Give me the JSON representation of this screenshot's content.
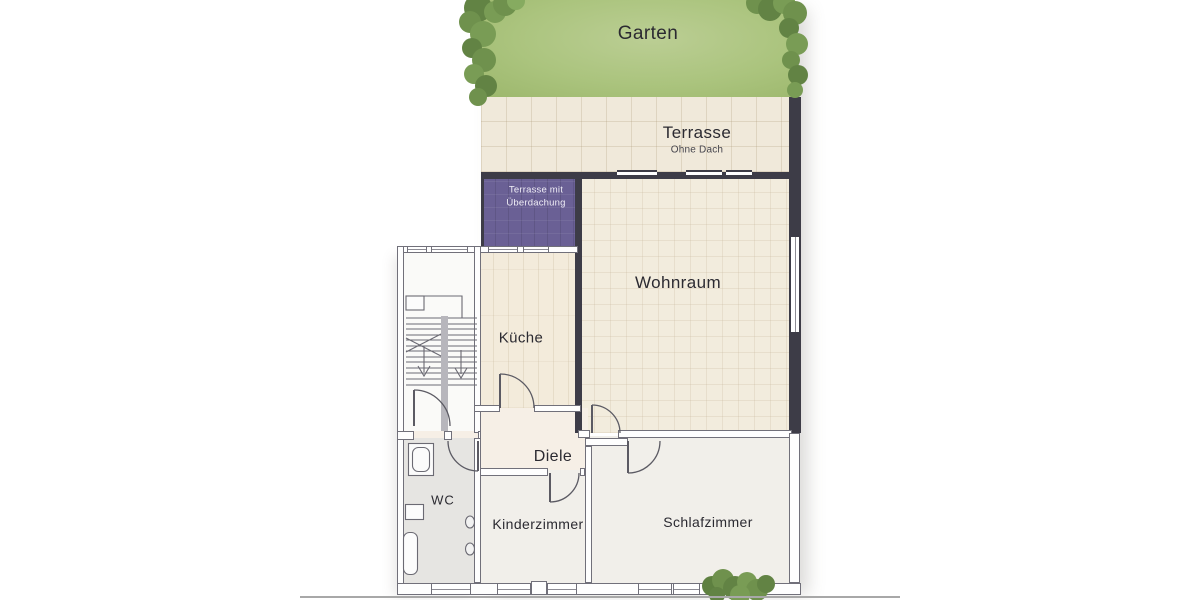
{
  "floorplan": {
    "outdoor": {
      "garten": {
        "label": "Garten"
      },
      "terrasse": {
        "label": "Terrasse",
        "subtitle": "Ohne Dach"
      },
      "covered_terrace": {
        "label_line1": "Terrasse mit",
        "label_line2": "Überdachung"
      }
    },
    "rooms": {
      "wohnraum": {
        "label": "Wohnraum"
      },
      "kueche": {
        "label": "Küche"
      },
      "diele": {
        "label": "Diele"
      },
      "wc": {
        "label": "WC"
      },
      "kinderzimmer": {
        "label": "Kinderzimmer"
      },
      "schlafzimmer": {
        "label": "Schlafzimmer"
      }
    },
    "colors": {
      "grass": "#abc47e",
      "shrub": "#688a47",
      "terrace_tile": "#f0e9da",
      "covered_terrace": "#6a6095",
      "covered_terrace_text": "#efedf6",
      "living_room_tile": "#f2ecdd",
      "kitchen_floor": "#f3ebdb",
      "hall_floor": "#f6efe6",
      "bedroom_floor": "#f1efea",
      "wc_floor": "#e6e5e2",
      "dark_wall": "#3d3c47",
      "thin_wall_outline": "#71707a",
      "label_text": "#2b2a31"
    }
  }
}
